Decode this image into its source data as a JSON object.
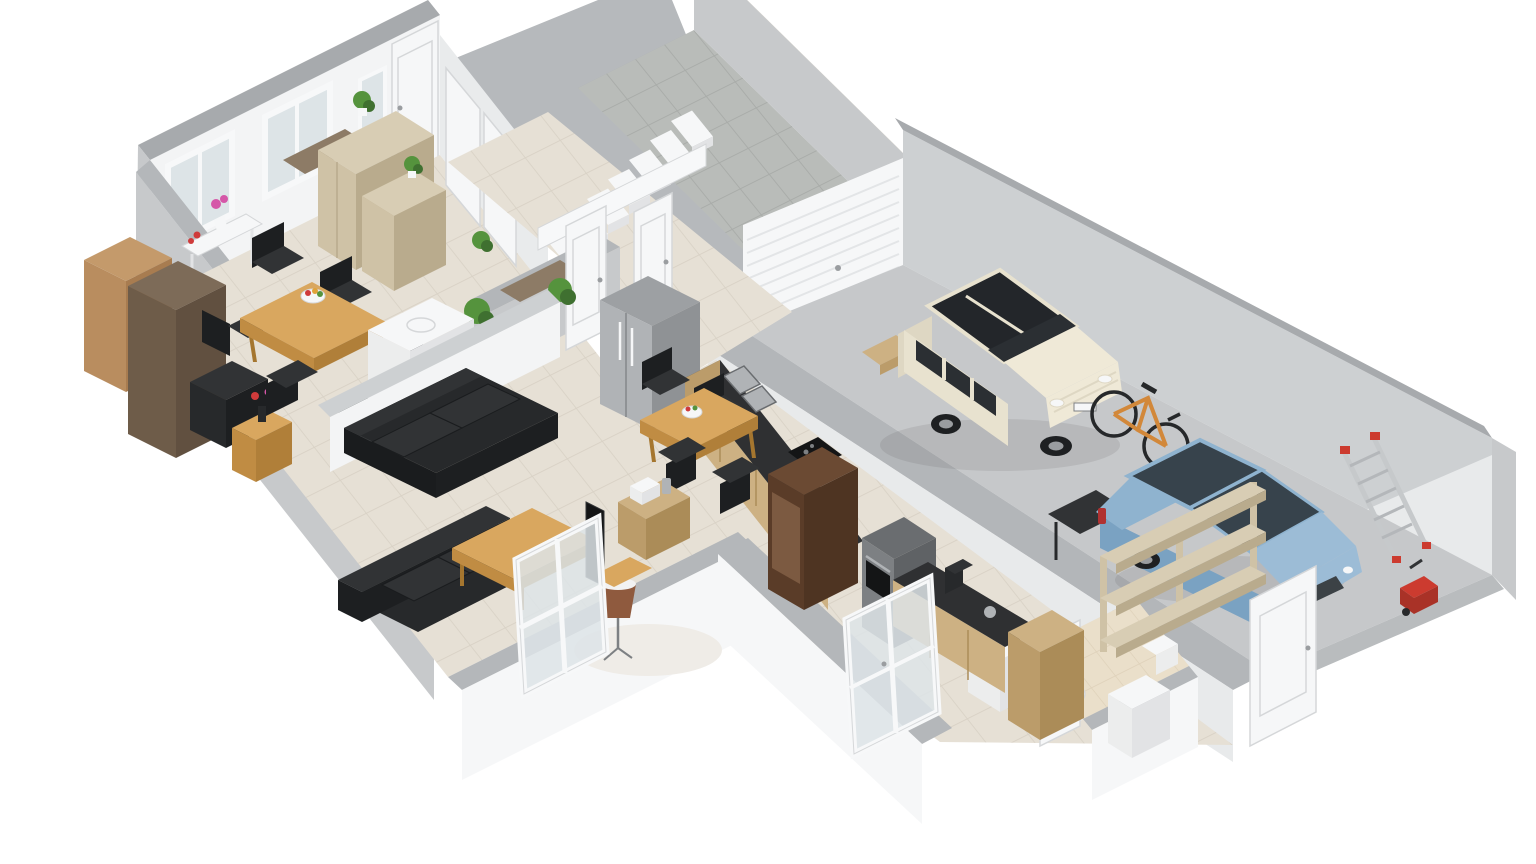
{
  "meta": {
    "kind": "3d-floor-plan-render",
    "view": "isometric dollhouse cutaway, ground floor",
    "background": "#ffffff"
  },
  "rooms": [
    {
      "name": "living-dining-room",
      "floor": "beige ceramic tile"
    },
    {
      "name": "entry-hall-with-stairs",
      "floor": "beige ceramic tile"
    },
    {
      "name": "kitchen",
      "floor": "beige ceramic tile"
    },
    {
      "name": "wc-bathroom",
      "floor": "beige tile"
    },
    {
      "name": "garage",
      "floor": "concrete"
    },
    {
      "name": "driveway-patio",
      "floor": "grey paving blocks"
    }
  ],
  "objects": {
    "living_dining": [
      "dining-table",
      "6 black dining chairs",
      "fruit-bowl",
      "white-console-table",
      "flower-vases",
      "tan-cabinet",
      "dark-brown-wardrobe",
      "black-media-desk",
      "wood-side-table",
      "tall-pale-cabinet",
      "low-pale-cabinet",
      "potted-plants",
      "white-sideboard",
      "stainless-fridge",
      "black-sofa-2seat",
      "black-sofa-3seat",
      "wood-coffee-table",
      "floor-lamp",
      "tv-panel",
      "white-rug",
      "leaning-french-window"
    ],
    "hall": [
      "staircase",
      "white-balustrade",
      "closet-double-doors",
      "interior-doors",
      "grey-console-with-plant"
    ],
    "kitchen": [
      "counter-run-sink",
      "gas-hob",
      "oven-tall-unit",
      "counter-run-coffee",
      "coffee-machine",
      "oak-tall-cabinet",
      "walnut-display-unit",
      "kitchen-table",
      "4 black chairs",
      "toaster-sideboard",
      "toaster",
      "kettle",
      "french-doors",
      "washing-machine"
    ],
    "bathroom": [
      "toilet",
      "wall-basin",
      "white-cabinet",
      "door"
    ],
    "garage": [
      "cream-minivan",
      "blue-hatchback",
      "orange-bicycle",
      "aluminium-ladder",
      "storage-rack",
      "workbench",
      "pressure-washer",
      "wood-step",
      "garage-sectional-door",
      "side-door"
    ],
    "exterior": [
      "driveway-paving",
      "garden-wall-beige-coping"
    ]
  },
  "vehicles": [
    {
      "name": "minivan",
      "body": "#e8e2cf",
      "glass": "#23262a"
    },
    {
      "name": "hatchback",
      "body": "#8fb3cf",
      "glass": "#37434c"
    }
  ],
  "palette": {
    "wall_top": "#a7aaad",
    "wall_top_light": "#b4b7ba",
    "halfwall_top": "#b3b6b9",
    "wall_outer": "#c7c9cb",
    "wall_outer_dark": "#b9bcbe",
    "wall_inner": "#f3f4f5",
    "wall_inner_shadow": "#e9ebec",
    "wall_gray_face": "#b6b9bc",
    "wall_light_face": "#cdd0d2",
    "wall_end": "#e8eaeb",
    "floor_tile": "#e6e0d5",
    "floor_grout": "#d9d2c6",
    "bath_tile": "#eadfca",
    "bath_grout": "#ddd0b8",
    "paving": "#b9bcb9",
    "paving_grout": "#a9aca9",
    "concrete": "#c6c8ca",
    "coping": "#cfc7b5",
    "glass_pale": "#dde4e7",
    "frame_white": "#f7f8f9",
    "frame_stroke": "#d5d7d9",
    "door_slat": "#e3e5e7",
    "wood_top": "#d9a75f",
    "wood_mid": "#c08c43",
    "wood_side": "#b07f39",
    "wood_dark": "#a5762f",
    "oak_light": "#cdb183",
    "oak_mid": "#bb9c6a",
    "oak_dark": "#ab8c58",
    "pale_top": "#d8cdb4",
    "pale_mid": "#cfc2a6",
    "pale_dark": "#b9ab8d",
    "tan_top": "#c49a6b",
    "tan_mid": "#b98d5f",
    "tan_dark": "#a87c50",
    "brown_top": "#7d6b58",
    "brown_mid": "#6e5c49",
    "brown_dark": "#615040",
    "bench_brown": "#8d7b66",
    "walnut_top": "#6b4a33",
    "walnut_mid": "#5a3c28",
    "walnut_dark": "#4e3422",
    "walnut_glass": "#7c5a41",
    "black_top": "#313335",
    "black_mid": "#27292b",
    "black_dark": "#1d1f21",
    "black_edge": "#1a1c1e",
    "white_f": "#f6f7f8",
    "white_f_mid": "#eceded",
    "white_f_dark": "#e2e3e5",
    "counter_dark": "#2f3032",
    "steel": "#b0b3b6",
    "steel_dark": "#8f9295",
    "steel_top": "#9da0a3",
    "gray_unit_top": "#6a6d70",
    "gray_unit": "#7d8083",
    "gray_unit_dark": "#5f6265",
    "appliance_black": "#141516",
    "van_body": "#e8e2cf",
    "van_body_light": "#efe9d7",
    "van_body_dark": "#ded7c3",
    "van_glass": "#2b2f33",
    "van_roof": "#23262a",
    "car_blue": "#8fb3cf",
    "car_blue_light": "#9cbcd6",
    "car_blue_dark": "#7aa2c2",
    "car_glass": "#37434c",
    "grille": "#3c4246",
    "wheel": "#1e2022",
    "hub": "#9a9da0",
    "taillight": "#b03232",
    "bike_orange": "#d2883a",
    "bike_dark": "#26282a",
    "ladder": "#c6c9cb",
    "ladder_rung": "#b4b7ba",
    "red": "#cc3b2f",
    "red_dark": "#a93227",
    "plant": "#55933d",
    "plant_dark": "#3f7030",
    "flower_pink": "#d557a8",
    "flower_red": "#cf3b3b",
    "fruit_orange": "#e0a33a",
    "lamp_shade": "#8f5a3e",
    "lamp_top": "#f2f2f2",
    "rug": "#efece7",
    "shadow": "rgba(70,70,70,0.12)"
  }
}
